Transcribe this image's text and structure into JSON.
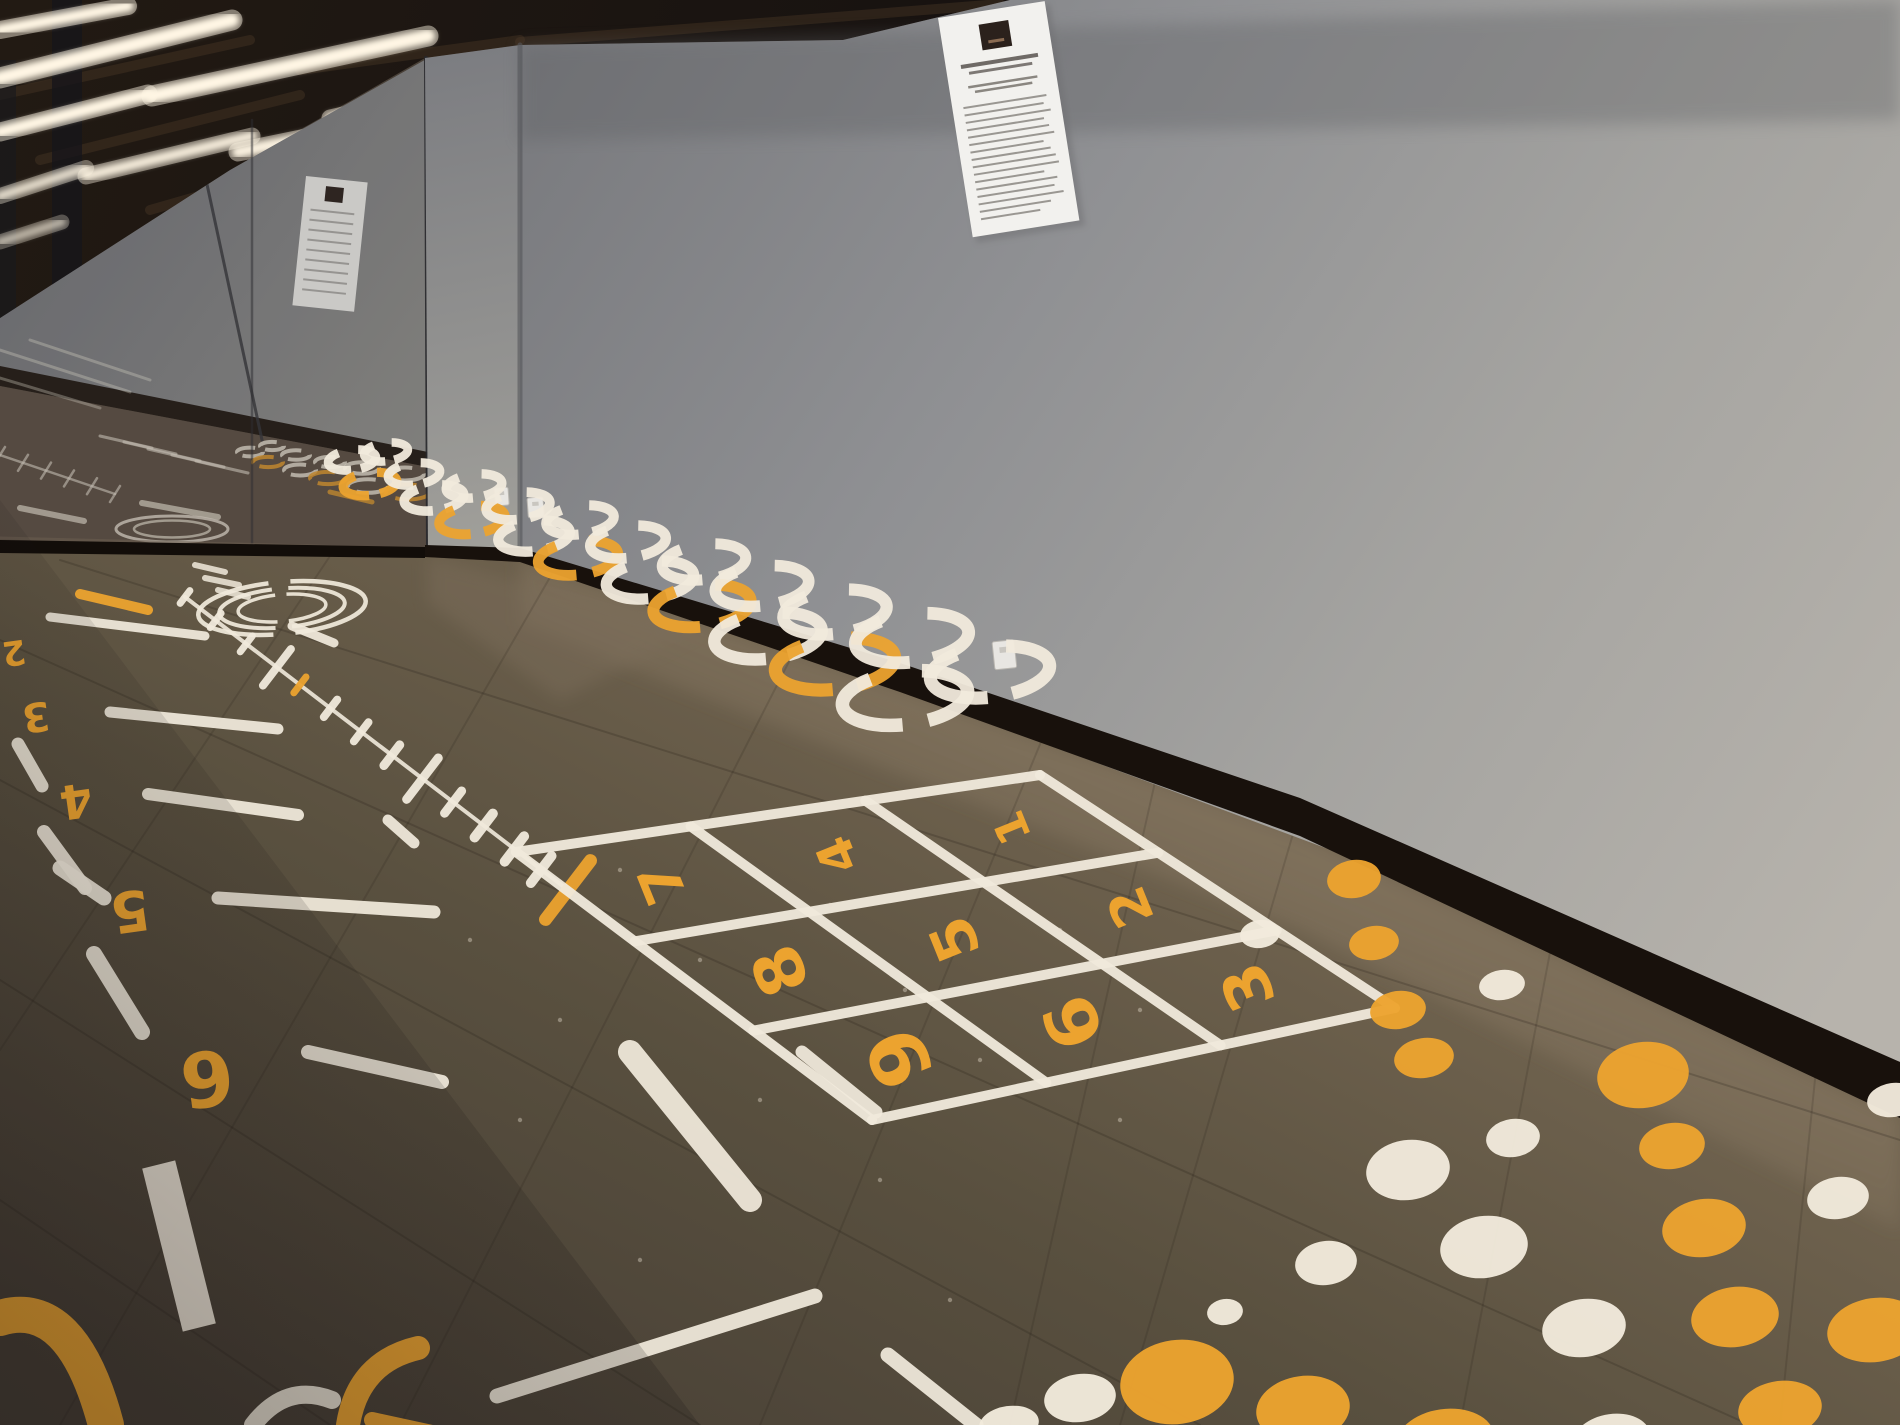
{
  "scene": {
    "description": "Indoor gym corridor with dark rubber tile floor covered in painted agility/game markings, mirror wall on the left, plain gray wall with a posted notice on the right, and linear LED strip lights on a dark ceiling",
    "palette": {
      "paint_white": "#f1eadc",
      "paint_orange": "#eca32f",
      "floor_far": "#70634f",
      "floor_near": "#453d34",
      "wall_gray_dark": "#737479",
      "wall_gray_light": "#b7b3ac",
      "baseboard_black": "#18110c",
      "ceiling_dark": "#1b1510",
      "light_warm_white": "#fff6e4"
    }
  },
  "ceiling": {
    "light_strip_count": 7,
    "reflected_light_strip_count": 2
  },
  "right_wall": {
    "poster": {
      "present": true,
      "text_legible": false,
      "has_dark_logo_square": true,
      "body_text_line_count": 16
    },
    "outlet_count": 1
  },
  "far_wall": {
    "outlet_count": 2
  },
  "mirror_wall": {
    "reflections": [
      "ceiling lights",
      "gray wall",
      "poster",
      "floor markings",
      "target circle"
    ]
  },
  "floor": {
    "grid": {
      "rows": 3,
      "cols": 3,
      "numbers": [
        "1",
        "2",
        "3",
        "4",
        "5",
        "6",
        "7",
        "8",
        "9"
      ],
      "number_color": "#eca32f",
      "line_color": "#f1eadc"
    },
    "distance_numbers": [
      "2",
      "3",
      "4",
      "5",
      "6"
    ],
    "rings": {
      "count": 22,
      "pattern": [
        "w",
        "w",
        "o",
        "w",
        "w",
        "w",
        "o",
        "w",
        "w",
        "w",
        "o",
        "w",
        "w",
        "w",
        "o",
        "w",
        "w",
        "w",
        "o",
        "w",
        "w",
        "w"
      ]
    },
    "target_circles": {
      "ring_count": 3
    },
    "ruler": {
      "tick_count": 14,
      "orange_tick_indexes": [
        4,
        13
      ]
    },
    "dots": {
      "count": 26,
      "pattern": [
        "o",
        "o",
        "o",
        "o",
        "o",
        "o",
        "o",
        "o",
        "o",
        "o",
        "o",
        "o",
        "o",
        "w",
        "w",
        "w",
        "w",
        "w",
        "w",
        "w",
        "w",
        "w",
        "w",
        "w",
        "w",
        "w"
      ]
    }
  }
}
